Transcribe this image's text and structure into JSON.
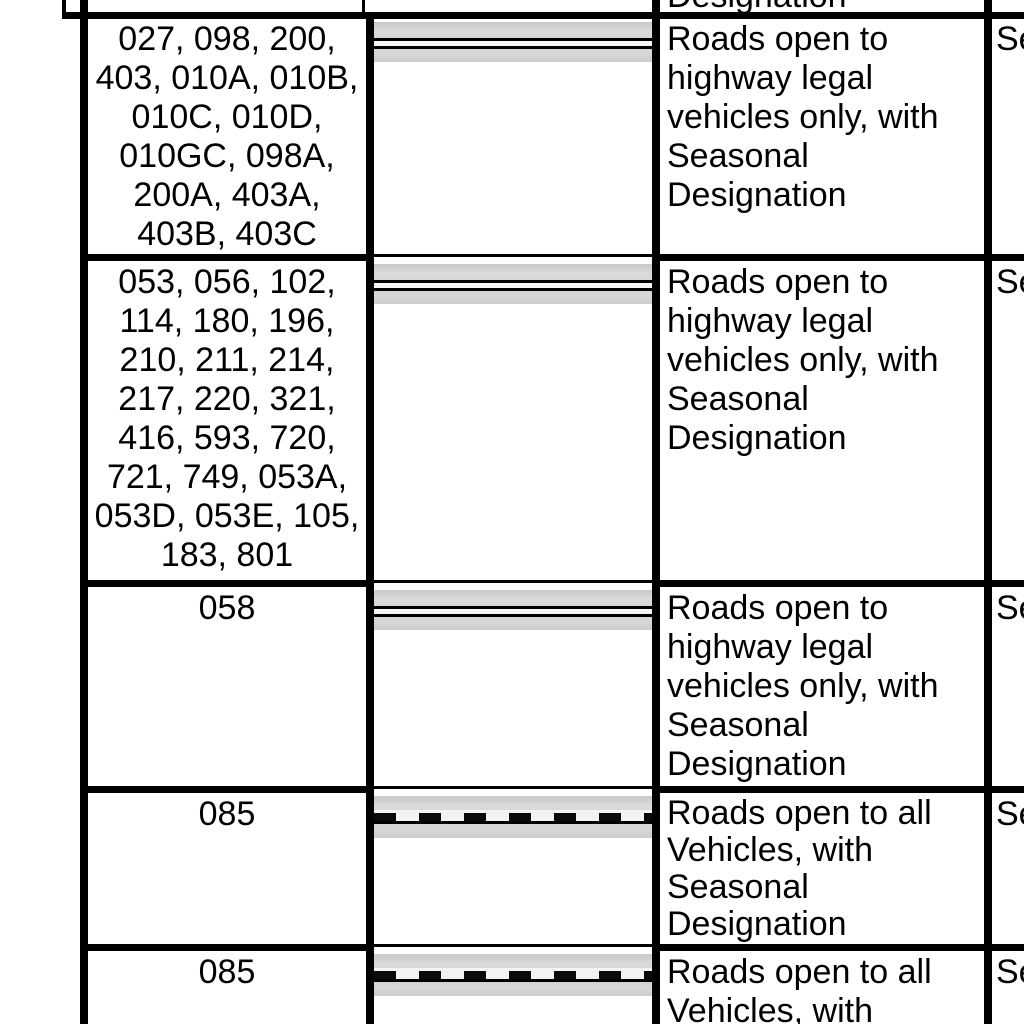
{
  "document": {
    "type": "road designation table detail",
    "background": "#ffffff"
  },
  "colors": {
    "grid": "#000000",
    "text": "#000000",
    "symbol_casing_gray": "#d2d2d2",
    "symbol_inner_light": "#f5f5f5",
    "symbol_line_black": "#000000"
  },
  "partial_top_row": {
    "description_clipped_text": "Designation"
  },
  "rows": [
    {
      "road_numbers_lines": [
        "027, 098, 200,",
        "403, 010A, 010B,",
        "010C, 010D,",
        "010GC, 098A,",
        "200A, 403A,",
        "403B, 403C"
      ],
      "symbol": "solid double-line road symbol (gray casing, two black lines)",
      "description_lines": [
        "Roads open to",
        "highway legal",
        "vehicles only, with",
        "Seasonal",
        "Designation"
      ],
      "right_column_visible_text": "Se"
    },
    {
      "road_numbers_lines": [
        "053, 056, 102,",
        "114, 180, 196,",
        "210, 211, 214,",
        "217, 220, 321,",
        "416, 593, 720,",
        "721, 749, 053A,",
        "053D, 053E, 105,",
        "183, 801"
      ],
      "symbol": "solid double-line road symbol (gray casing, two black lines)",
      "description_lines": [
        "Roads open to",
        "highway legal",
        "vehicles only, with",
        "Seasonal",
        "Designation"
      ],
      "right_column_visible_text": "Se"
    },
    {
      "road_numbers_lines": [
        "058"
      ],
      "symbol": "solid double-line road symbol (gray casing, two black lines)",
      "description_lines": [
        "Roads open to",
        "highway legal",
        "vehicles only, with",
        "Seasonal",
        "Designation"
      ],
      "right_column_visible_text": "Se"
    },
    {
      "road_numbers_lines": [
        "085"
      ],
      "symbol": "dashed road symbol (gray casing, black dashes over solid line)",
      "description_lines": [
        "Roads open to all",
        "Vehicles, with",
        "Seasonal",
        "Designation"
      ],
      "right_column_visible_text": "Se"
    },
    {
      "road_numbers_lines": [
        "085"
      ],
      "symbol": "dashed road symbol (gray casing, black dashes over solid line)",
      "description_lines": [
        "Roads open to all",
        "Vehicles, with"
      ],
      "right_column_visible_text": "Se"
    }
  ]
}
